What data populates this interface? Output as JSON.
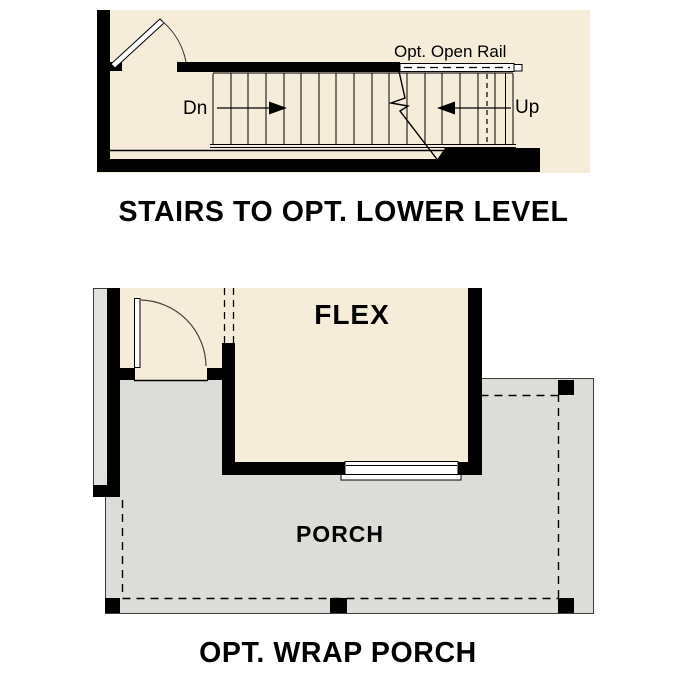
{
  "colors": {
    "cream": "#f5ecda",
    "porch_gray": "#dcdcd9",
    "strip_gray": "#e2e2df",
    "wall_black": "#000000",
    "line": "#3c3c3c",
    "page_bg": "#ffffff"
  },
  "stair_diagram": {
    "title": "STAIRS TO OPT. LOWER LEVEL",
    "rail_label": "Opt. Open Rail",
    "down_label": "Dn",
    "up_label": "Up"
  },
  "porch_plan": {
    "title": "OPT. WRAP PORCH",
    "flex_label": "FLEX",
    "porch_label": "PORCH"
  }
}
